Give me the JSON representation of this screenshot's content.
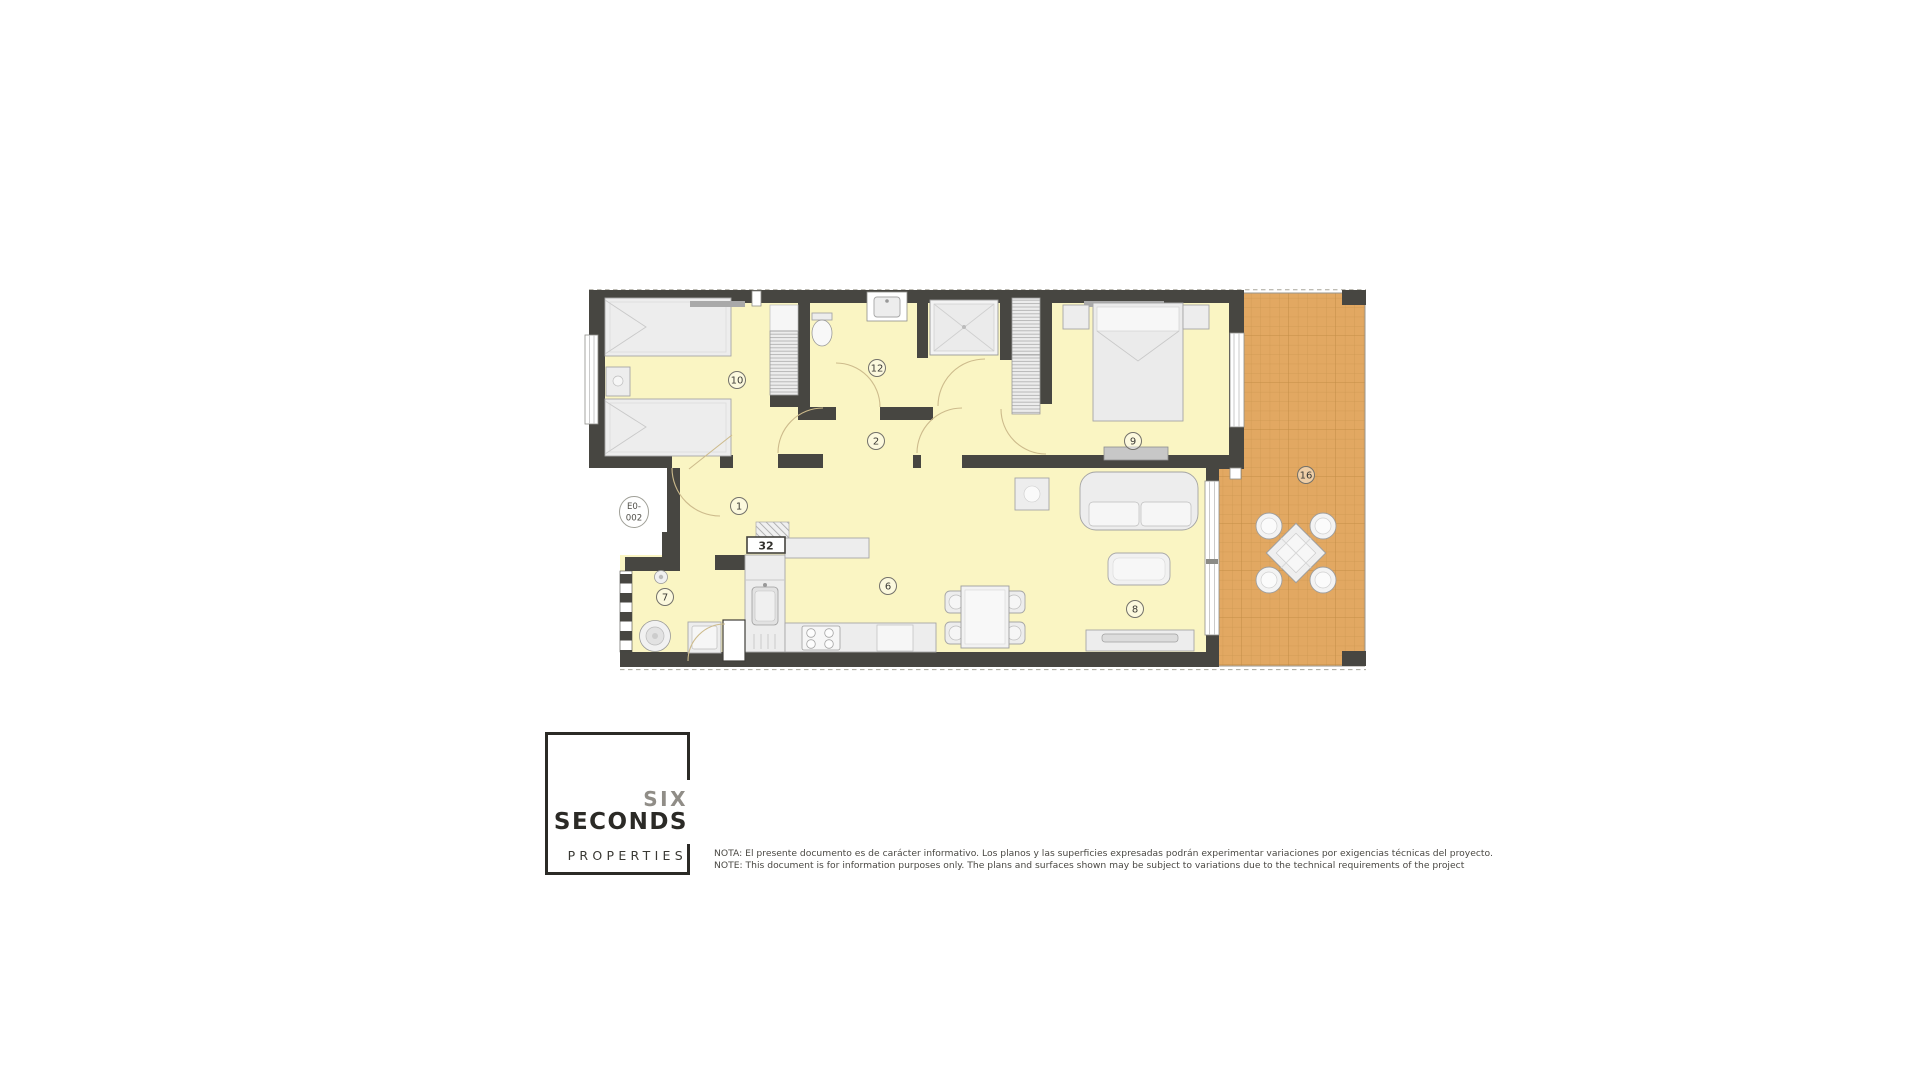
{
  "plan": {
    "unit_label": {
      "line1": "E0-",
      "line2": "002"
    },
    "room_labels": [
      "10",
      "12",
      "2",
      "9",
      "1",
      "6",
      "7",
      "8",
      "16"
    ],
    "boxed_label": "32",
    "colors": {
      "wall": "#474641",
      "floor": "#FAF5C3",
      "terrace_tile": "#E2A862",
      "terrace_grout": "#CD9850",
      "door_arc": "#CDBB8C"
    }
  },
  "logo": {
    "word1": "SIX",
    "word2": "SECONDS",
    "word3": "PROPERTIES"
  },
  "note": {
    "spanish": "NOTA: El presente documento es de carácter informativo. Los planos y las superficies expresadas podrán experimentar variaciones por exigencias técnicas del proyecto.",
    "english": "NOTE: This document is for information purposes only. The plans and surfaces shown may be subject to variations due to the technical requirements of the project"
  }
}
